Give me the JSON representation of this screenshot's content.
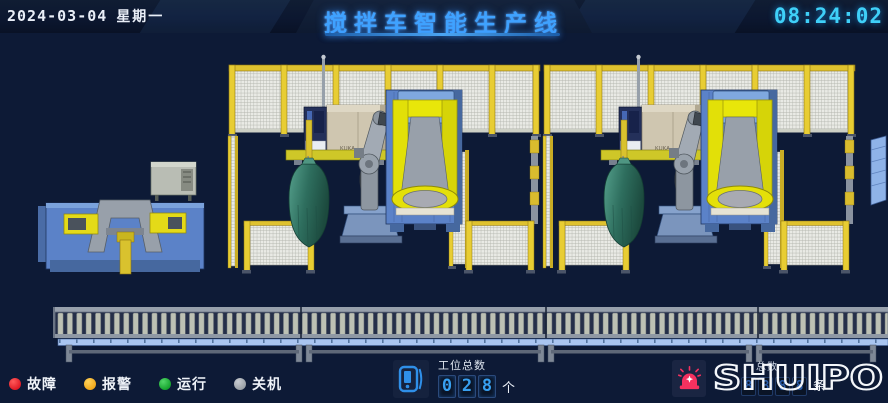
{
  "header": {
    "date": "2024-03-04",
    "weekday": "星期一",
    "title": "搅拌车智能生产线",
    "time": "08:24:02",
    "title_color": "#3fa2ff",
    "time_color": "#3fd0f8"
  },
  "status_legend": {
    "items": [
      {
        "id": "fault",
        "label": "故障",
        "color": "#e01b26"
      },
      {
        "id": "alarm",
        "label": "报警",
        "color": "#f0a81c"
      },
      {
        "id": "running",
        "label": "运行",
        "color": "#16a42e"
      },
      {
        "id": "off",
        "label": "关机",
        "color": "#9aa0a6"
      }
    ]
  },
  "station_counter": {
    "label": "工位总数",
    "digits": [
      "0",
      "2",
      "8"
    ],
    "unit": "个"
  },
  "partial_counter": {
    "label_visible": "总数",
    "ghost_digits": [
      "8",
      "8",
      "8",
      "8"
    ],
    "unit": "条"
  },
  "brand": {
    "logo_text": "SHUIPO",
    "beacon_color": "#f5315f"
  },
  "scene": {
    "robot_brand": "KUKA",
    "colors": {
      "background": "#0d1a36",
      "fence_yellow": "#e8cd33",
      "machine_blue": "#5b82c8",
      "robot_yellow": "#e8e60a",
      "drum_green": "#2e6e5e",
      "conveyor_rail_blue": "#a9c5f0"
    }
  }
}
